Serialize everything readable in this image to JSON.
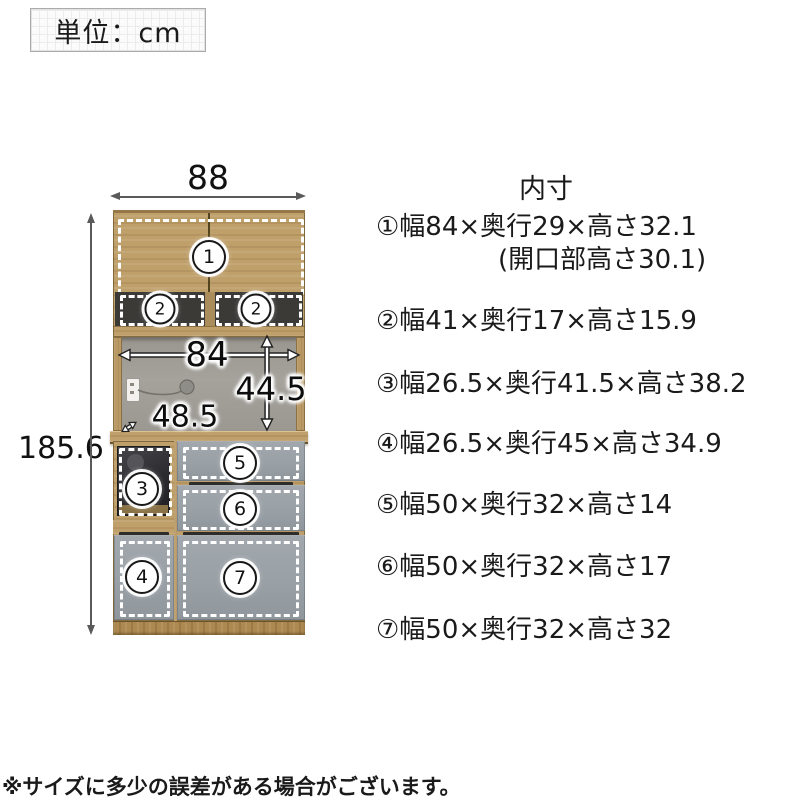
{
  "unit_box": {
    "label": "単位：cm"
  },
  "diagram": {
    "width_label": "88",
    "height_label": "185.6",
    "inner_width_label": "84",
    "inner_height_label": "44.5",
    "counter_depth_label": "48.5",
    "circle_labels": {
      "c1": "1",
      "c2l": "2",
      "c2r": "2",
      "c3": "3",
      "c4": "4",
      "c5": "5",
      "c6": "6",
      "c7": "7"
    }
  },
  "specs": {
    "title": "内寸",
    "items": [
      "①幅84×奥行29×高さ32.1",
      "(開口部高さ30.1)",
      "②幅41×奥行17×高さ15.9",
      "③幅26.5×奥行41.5×高さ38.2",
      "④幅26.5×奥行45×高さ34.9",
      "⑤幅50×奥行32×高さ14",
      "⑥幅50×奥行32×高さ17",
      "⑦幅50×奥行32×高さ32"
    ]
  },
  "note": {
    "text": "※サイズに多少の誤差がある場合がございます。"
  }
}
